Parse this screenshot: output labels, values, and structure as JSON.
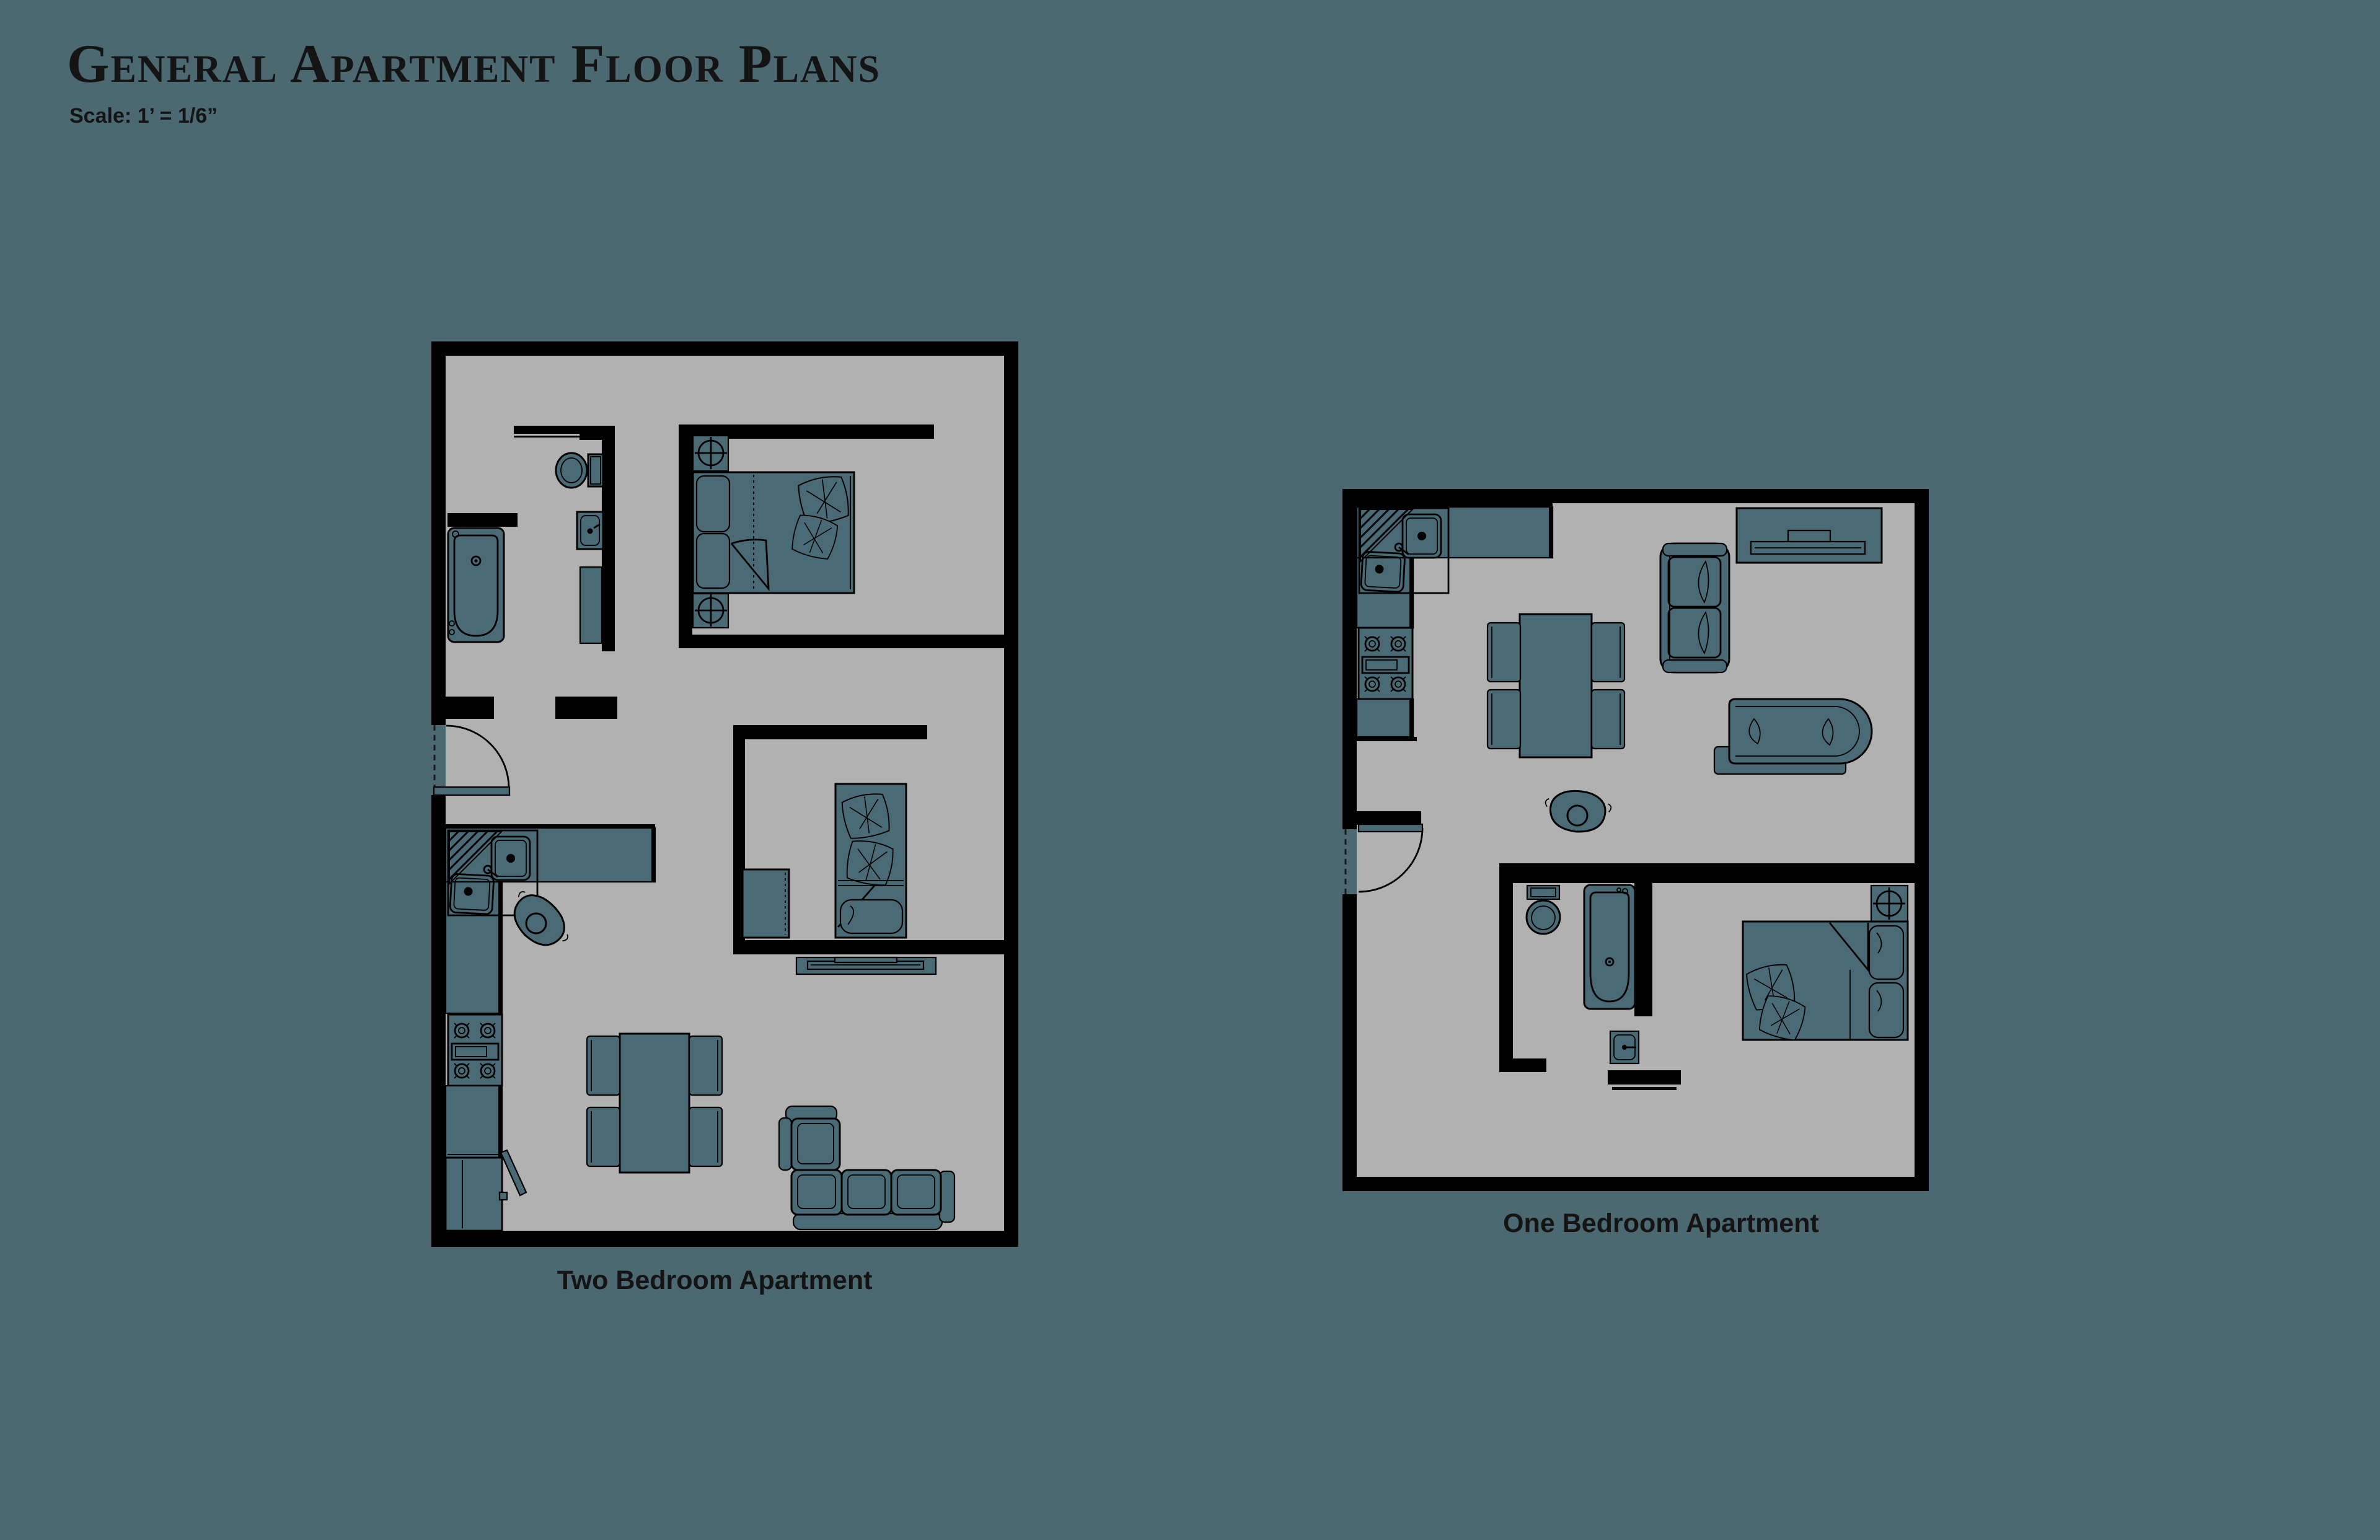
{
  "page": {
    "title": "General Apartment Floor Plans",
    "scale_note": "Scale: 1’ = 1/6”"
  },
  "colors": {
    "background": "#4C6972",
    "floor": "#B1B1B1",
    "furniture_fill": "#4A6A75",
    "wall": "#000000",
    "label_text": "#141414"
  },
  "plans": [
    {
      "id": "two-bedroom",
      "label": "Two Bedroom Apartment",
      "rooms": [
        "bathroom",
        "closet",
        "master-bedroom",
        "second-bedroom",
        "kitchen",
        "living-dining",
        "entry"
      ],
      "furniture": [
        "toilet",
        "bathroom-sink",
        "bathtub",
        "bathroom-cabinet",
        "double-bed",
        "nightstand-lamp",
        "nightstand-lamp",
        "single-bed",
        "dresser",
        "tv-console",
        "corner-kitchen-sink",
        "stove",
        "kitchen-counter",
        "refrigerator",
        "dining-table",
        "chair",
        "chair",
        "chair",
        "chair",
        "sectional-sofa",
        "person",
        "entry-door"
      ]
    },
    {
      "id": "one-bedroom",
      "label": "One Bedroom Apartment",
      "rooms": [
        "kitchen",
        "living-dining",
        "bathroom",
        "bedroom",
        "entry"
      ],
      "furniture": [
        "corner-kitchen-sink",
        "stove",
        "kitchen-counter",
        "tv-console",
        "sofa",
        "chaise-lounge",
        "dining-table",
        "chair",
        "chair",
        "chair",
        "chair",
        "person",
        "toilet",
        "bathtub",
        "bathroom-sink",
        "double-bed",
        "nightstand-lamp",
        "entry-door"
      ]
    }
  ]
}
